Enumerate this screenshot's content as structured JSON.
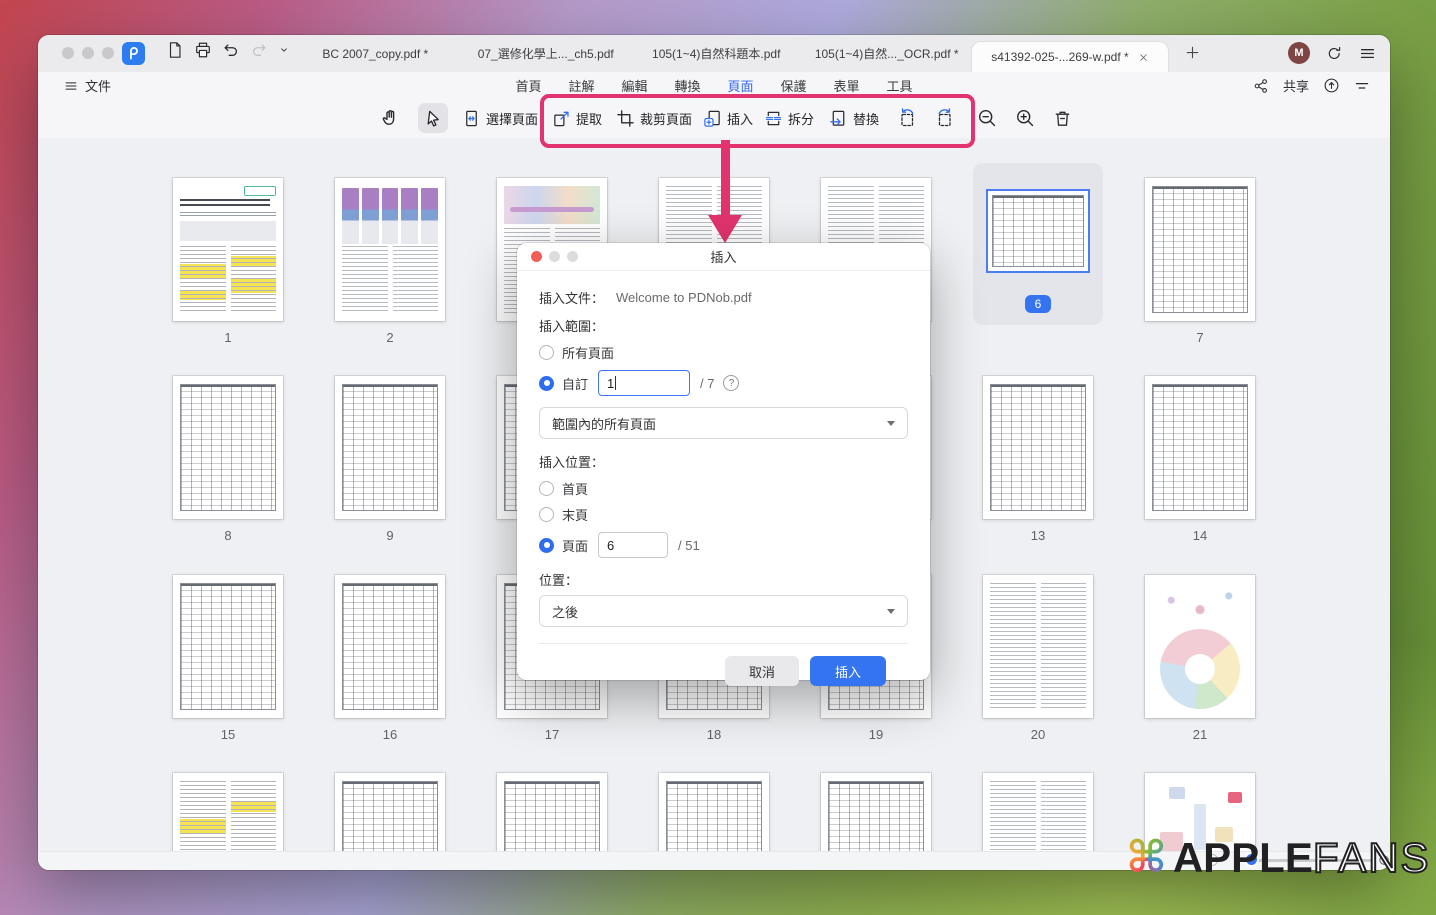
{
  "titlebar": {
    "tabs": [
      {
        "label": "BC 2007_copy.pdf *",
        "active": false
      },
      {
        "label": "07_選修化學上..._ch5.pdf",
        "active": false
      },
      {
        "label": "105(1~4)自然科題本.pdf",
        "active": false
      },
      {
        "label": "105(1~4)自然..._OCR.pdf *",
        "active": false
      },
      {
        "label": "s41392-025-...269-w.pdf *",
        "active": true
      }
    ],
    "avatar": "M"
  },
  "menubar": {
    "file": "文件",
    "nav": [
      {
        "label": "首頁",
        "active": false
      },
      {
        "label": "註解",
        "active": false
      },
      {
        "label": "編輯",
        "active": false
      },
      {
        "label": "轉換",
        "active": false
      },
      {
        "label": "頁面",
        "active": true
      },
      {
        "label": "保護",
        "active": false
      },
      {
        "label": "表單",
        "active": false
      },
      {
        "label": "工具",
        "active": false
      }
    ],
    "share": "共享"
  },
  "toolbar": {
    "select_pages": "選擇頁面",
    "buttons": [
      {
        "label": "提取",
        "icon": "extract-icon"
      },
      {
        "label": "裁剪頁面",
        "icon": "crop-icon"
      },
      {
        "label": "插入",
        "icon": "insert-icon"
      },
      {
        "label": "拆分",
        "icon": "split-icon"
      },
      {
        "label": "替換",
        "icon": "replace-icon"
      }
    ]
  },
  "dialog": {
    "title": "插入",
    "file_label": "插入文件：",
    "file_value": "Welcome to PDNob.pdf",
    "range_label": "插入範圍：",
    "all_pages": "所有頁面",
    "custom": "自訂",
    "custom_value": "1",
    "custom_total": "/ 7",
    "range_option": "範圍內的所有頁面",
    "position_label": "插入位置：",
    "first_page": "首頁",
    "last_page": "末頁",
    "page": "頁面",
    "page_value": "6",
    "page_total": "/ 51",
    "location_label": "位置：",
    "location_value": "之後",
    "cancel": "取消",
    "confirm": "插入"
  },
  "grid": {
    "selected_page": "6",
    "pages": [
      {
        "num": "1",
        "kind": "article"
      },
      {
        "num": "2",
        "kind": "figcells"
      },
      {
        "num": "3",
        "kind": "figflow"
      },
      {
        "num": "4",
        "kind": "text"
      },
      {
        "num": "5",
        "kind": "text"
      },
      {
        "num": "6",
        "kind": "landscape"
      },
      {
        "num": "7",
        "kind": "table"
      },
      {
        "num": "8",
        "kind": "table"
      },
      {
        "num": "9",
        "kind": "table"
      },
      {
        "num": "10",
        "kind": "table"
      },
      {
        "num": "11",
        "kind": "table"
      },
      {
        "num": "12",
        "kind": "table"
      },
      {
        "num": "13",
        "kind": "table"
      },
      {
        "num": "14",
        "kind": "table"
      },
      {
        "num": "15",
        "kind": "table"
      },
      {
        "num": "16",
        "kind": "table"
      },
      {
        "num": "17",
        "kind": "table"
      },
      {
        "num": "18",
        "kind": "table"
      },
      {
        "num": "19",
        "kind": "table"
      },
      {
        "num": "20",
        "kind": "text"
      },
      {
        "num": "21",
        "kind": "wheel"
      },
      {
        "num": "22",
        "kind": "texthl"
      },
      {
        "num": "23",
        "kind": "table"
      },
      {
        "num": "24",
        "kind": "table"
      },
      {
        "num": "25",
        "kind": "table"
      },
      {
        "num": "26",
        "kind": "table"
      },
      {
        "num": "27",
        "kind": "text"
      },
      {
        "num": "28",
        "kind": "flowcolor"
      }
    ]
  },
  "watermark": {
    "brand_bold": "APPLE",
    "brand_light": "FANS",
    "mark": "⌘"
  },
  "colors": {
    "accent_blue": "#3574F0",
    "annotation_pink": "#E2336E",
    "highlight_yellow": "#F6E352",
    "nav_active": "#3268EF"
  }
}
